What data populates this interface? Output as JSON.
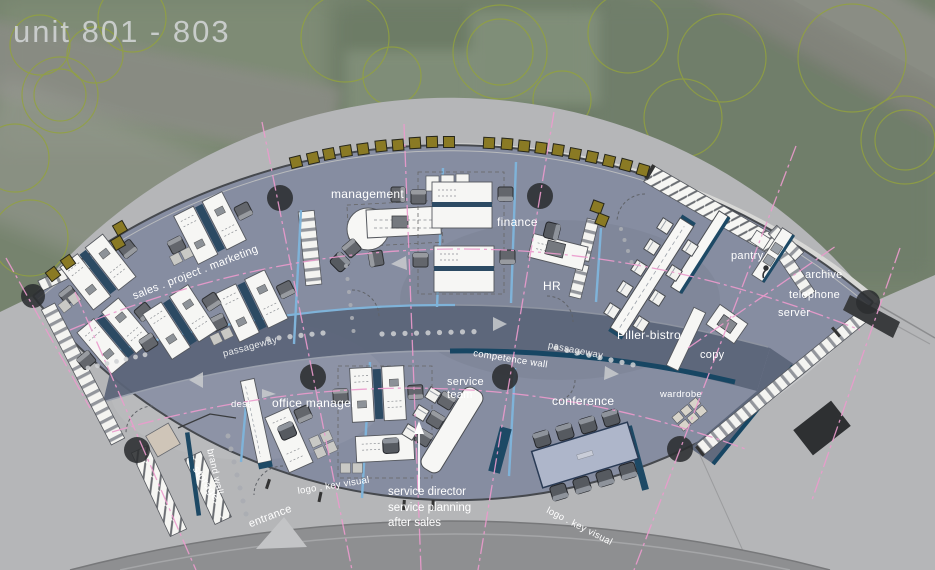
{
  "title": "unit 801 - 803",
  "labels": {
    "management": "management",
    "finance": "finance",
    "hr": "HR",
    "sales": "sales . project . marketing",
    "passageway_left": "passageway",
    "passageway_right": "passageway",
    "competence_wall": "competence wall",
    "piller_bistro": "Piller-bistro",
    "pantry": "pantry",
    "archive": "archive",
    "telephone": "telephone",
    "server": "server",
    "copy": "copy",
    "wardrobe": "wardrobe",
    "desk": "desk",
    "office_manager": "office manager",
    "service_team": "service\nteam",
    "conference": "conference",
    "storage": "storage",
    "brand_wall": "brand wall",
    "entrance": "entrance",
    "logo_key_visual_left": "logo . key visual",
    "logo_key_visual_right": "logo . key visual",
    "service_director": "service director",
    "service_planning": "service planning",
    "after_sales": "after sales"
  },
  "colors": {
    "axis_pink": "#ec9bcd",
    "accent_light_blue": "#7fb3d9",
    "accent_navy": "#1d4965",
    "olive_chair": "#8a7a24",
    "floor": "#868da1",
    "passageway": "#5a6478",
    "plaza": "#b5b6b8"
  }
}
